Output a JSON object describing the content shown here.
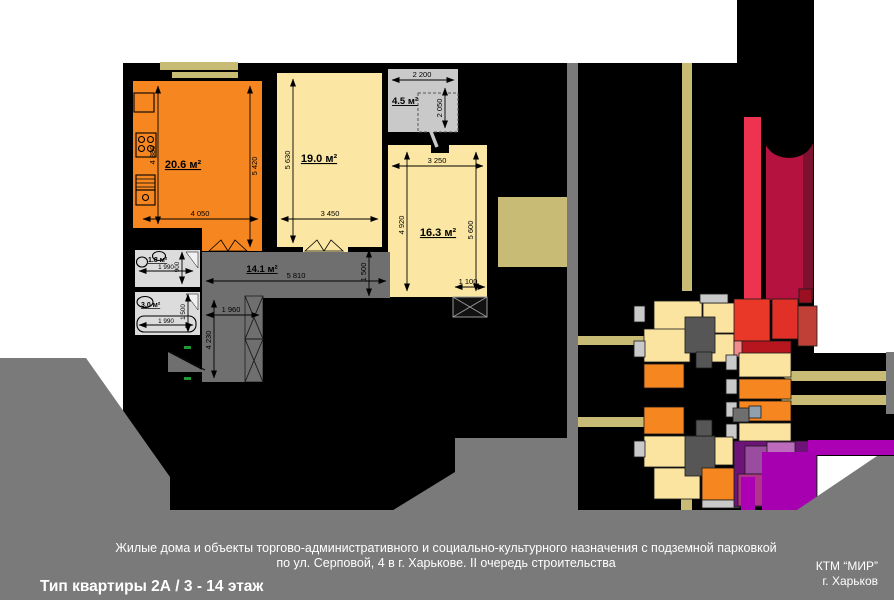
{
  "title_block": {
    "project_line1": "Жилые дома и объекты торгово-административного и социально-культурного назначения с подземной парковкой",
    "project_line2": "по ул. Серповой, 4 в г. Харькове. II очередь строительства",
    "apartment_type": "Тип квартиры 2А / 3 - 14 этаж",
    "company": "КТМ “МИР”",
    "city": "г. Харьков"
  },
  "colors": {
    "plan_background": "#000000",
    "footer_gray": "#7A7A7A",
    "kitchen_orange": "#F6861F",
    "room_yellow": "#FBE7A3",
    "loggia_gray": "#C9C9C9",
    "hall_gray": "#6F6F6F",
    "bath_gray": "#DCDCDC",
    "road_khaki": "#C8BB76",
    "accent_red_bright": "#ED3350",
    "accent_red_dark": "#B5123F",
    "accent_magenta": "#AB00B4",
    "accent_purple": "#A855A8"
  },
  "plan": {
    "rooms": [
      {
        "name": "kitchen-living",
        "area_label": "20.6 м²",
        "dim_left": "4 880",
        "dim_right": "5 420",
        "dim_bottom": "4 050"
      },
      {
        "name": "living-room",
        "area_label": "19.0 м²",
        "dim_left": "5 630",
        "dim_bottom": "3 450"
      },
      {
        "name": "loggia",
        "area_label": "4.5 м²",
        "dim_top": "2 200",
        "dim_right": "2 050"
      },
      {
        "name": "bedroom",
        "area_label": "16.3 м²",
        "dim_top": "3 250",
        "dim_left": "4 920",
        "dim_right": "5 600",
        "dim_bottom": "1 100"
      },
      {
        "name": "hallway",
        "area_label": "14.1 м²",
        "dim_top": "5 810",
        "dim_right": "1 500",
        "dim_inner": "1 960",
        "dim_left": "4 230"
      },
      {
        "name": "wc",
        "area_label": "1.8 м²",
        "dim_bottom": "1 990",
        "dim_right": "900"
      },
      {
        "name": "bathroom",
        "area_label": "3.0 м²",
        "dim_bottom": "1 990",
        "dim_right": "1 500"
      }
    ]
  }
}
